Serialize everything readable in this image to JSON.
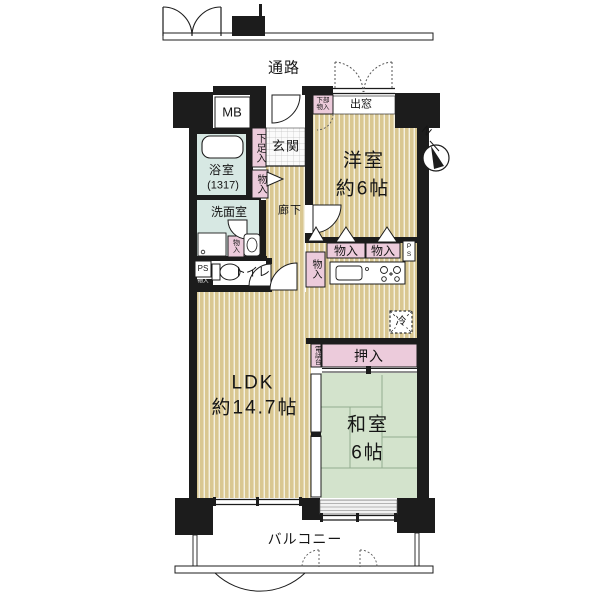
{
  "palette": {
    "wall": "#1c1c1c",
    "flooring_tan": "#d9c791",
    "closet_pink": "#eccbdb",
    "bath_blue": "#d7e8e3",
    "tatami_green": "#d3e3cc",
    "background": "#ffffff"
  },
  "outside": {
    "passage": "通路",
    "balcony": "バルコニー",
    "compass_n": "N"
  },
  "rooms": {
    "western_name": "洋室",
    "western_size": "約6帖",
    "ldk_name": "LDK",
    "ldk_size": "約14.7帖",
    "japanese_name": "和室",
    "japanese_size": "6帖",
    "entrance": "玄関",
    "hallway": "廊下",
    "bath_name": "浴室",
    "bath_size": "(1317)",
    "washroom": "洗面室",
    "toilet": "トイレ"
  },
  "storage": {
    "shoe_box": "下足入",
    "under_bay_1": "下部",
    "under_bay_2": "物入",
    "hall_closet": "物入",
    "wash_closet": "物入",
    "ps_shelf": "物入",
    "kitchen_closet_a": "物入",
    "kitchen_closet_b": "物入",
    "kitchen_closet_side": "物入",
    "oshiire": "押入",
    "phone_stand": "電話台"
  },
  "utilities": {
    "meter_box": "MB",
    "ps_left": "PS",
    "ps_right_1": "P",
    "ps_right_2": "S",
    "refrigerator": "冷",
    "bay_window": "出窓"
  }
}
